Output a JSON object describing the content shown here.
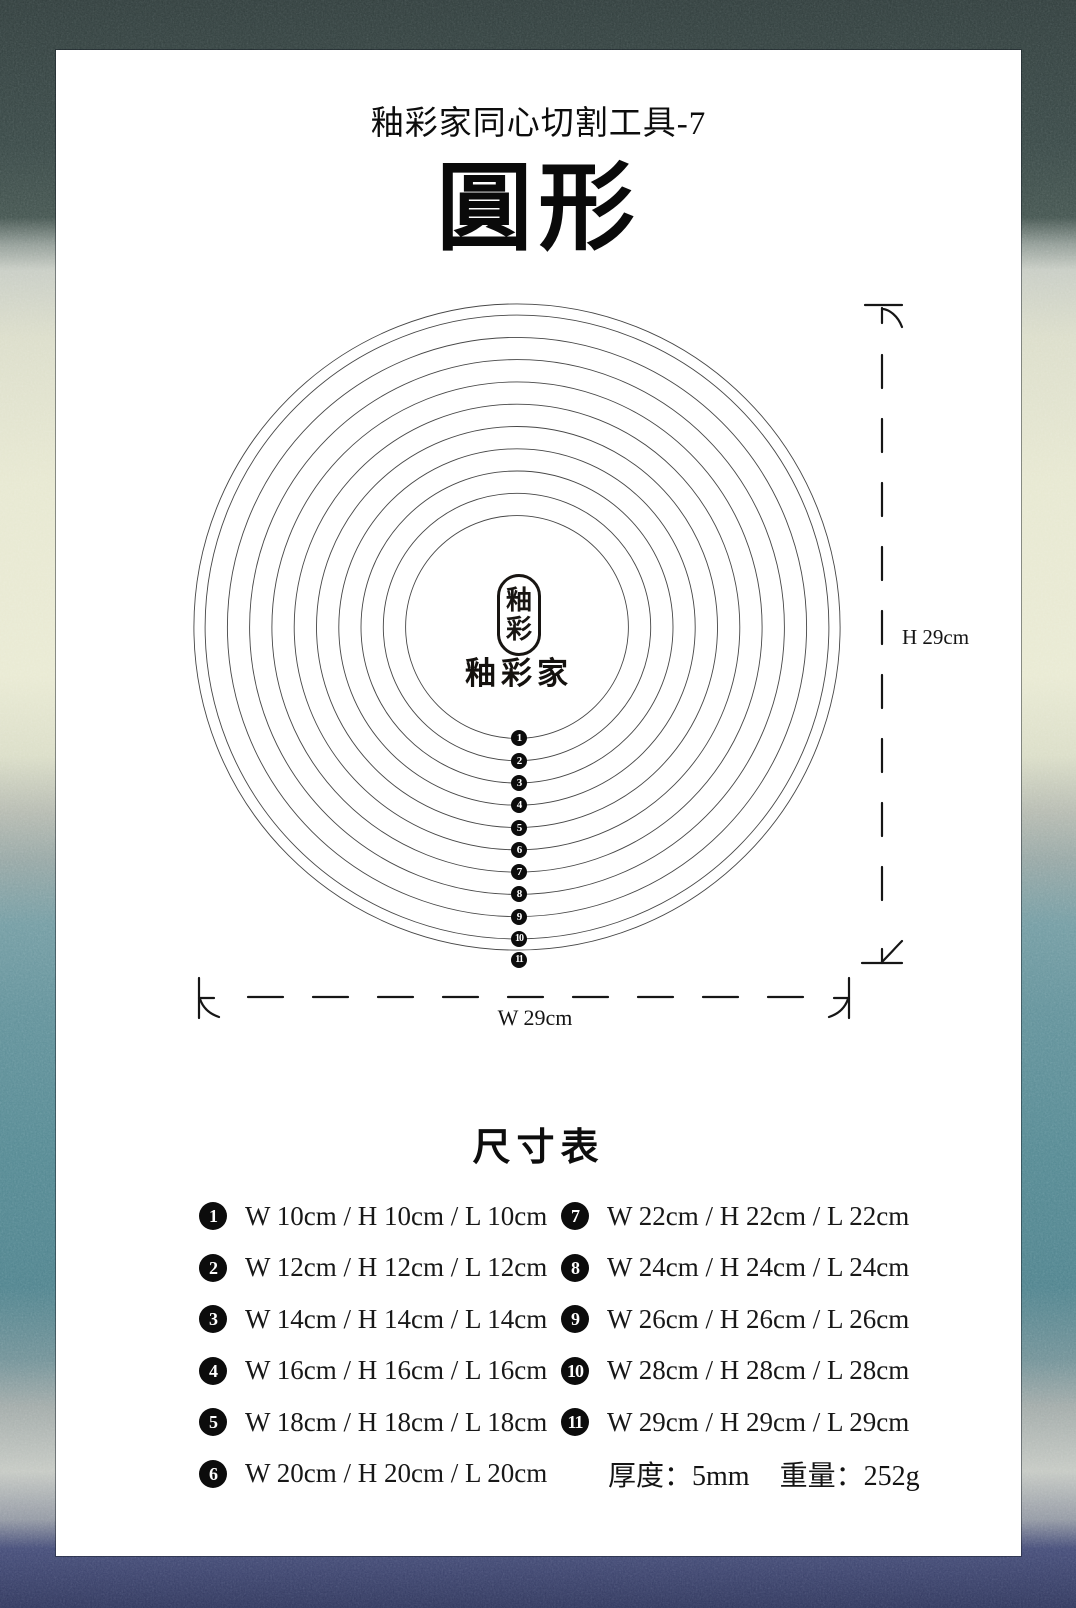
{
  "header": {
    "subtitle": "釉彩家同心切割工具-7",
    "title": "圓形"
  },
  "logo": {
    "seal_chars": [
      "釉",
      "彩"
    ],
    "brand": "釉彩家"
  },
  "diagram": {
    "circle_diameters_cm": [
      10,
      12,
      14,
      16,
      18,
      20,
      22,
      24,
      26,
      28,
      29
    ],
    "markers": [
      "1",
      "2",
      "3",
      "4",
      "5",
      "6",
      "7",
      "8",
      "9",
      "10",
      "11"
    ],
    "height_label": "H 29cm",
    "width_label": "W 29cm"
  },
  "size_table": {
    "title": "尺寸表",
    "rows": [
      {
        "num": "1",
        "label": "W 10cm / H 10cm / L 10cm"
      },
      {
        "num": "2",
        "label": "W 12cm / H 12cm / L 12cm"
      },
      {
        "num": "3",
        "label": "W 14cm / H 14cm / L 14cm"
      },
      {
        "num": "4",
        "label": "W 16cm / H 16cm / L 16cm"
      },
      {
        "num": "5",
        "label": "W 18cm / H 18cm / L 18cm"
      },
      {
        "num": "6",
        "label": "W 20cm / H 20cm / L 20cm"
      },
      {
        "num": "7",
        "label": "W 22cm / H 22cm / L 22cm"
      },
      {
        "num": "8",
        "label": "W 24cm / H 24cm / L 24cm"
      },
      {
        "num": "9",
        "label": "W 26cm / H 26cm / L 26cm"
      },
      {
        "num": "10",
        "label": "W 28cm / H 28cm / L 28cm"
      },
      {
        "num": "11",
        "label": "W 29cm / H 29cm / L 29cm"
      }
    ],
    "specs": {
      "thickness": "厚度：5mm",
      "weight": "重量：252g"
    }
  },
  "colors": {
    "ink": "#111111",
    "badge": "#0c0c0c",
    "border_dark_top": "#2b3837",
    "border_cream": "#e7e8d0",
    "border_teal": "#4f858f",
    "border_navy": "#2a3158"
  }
}
